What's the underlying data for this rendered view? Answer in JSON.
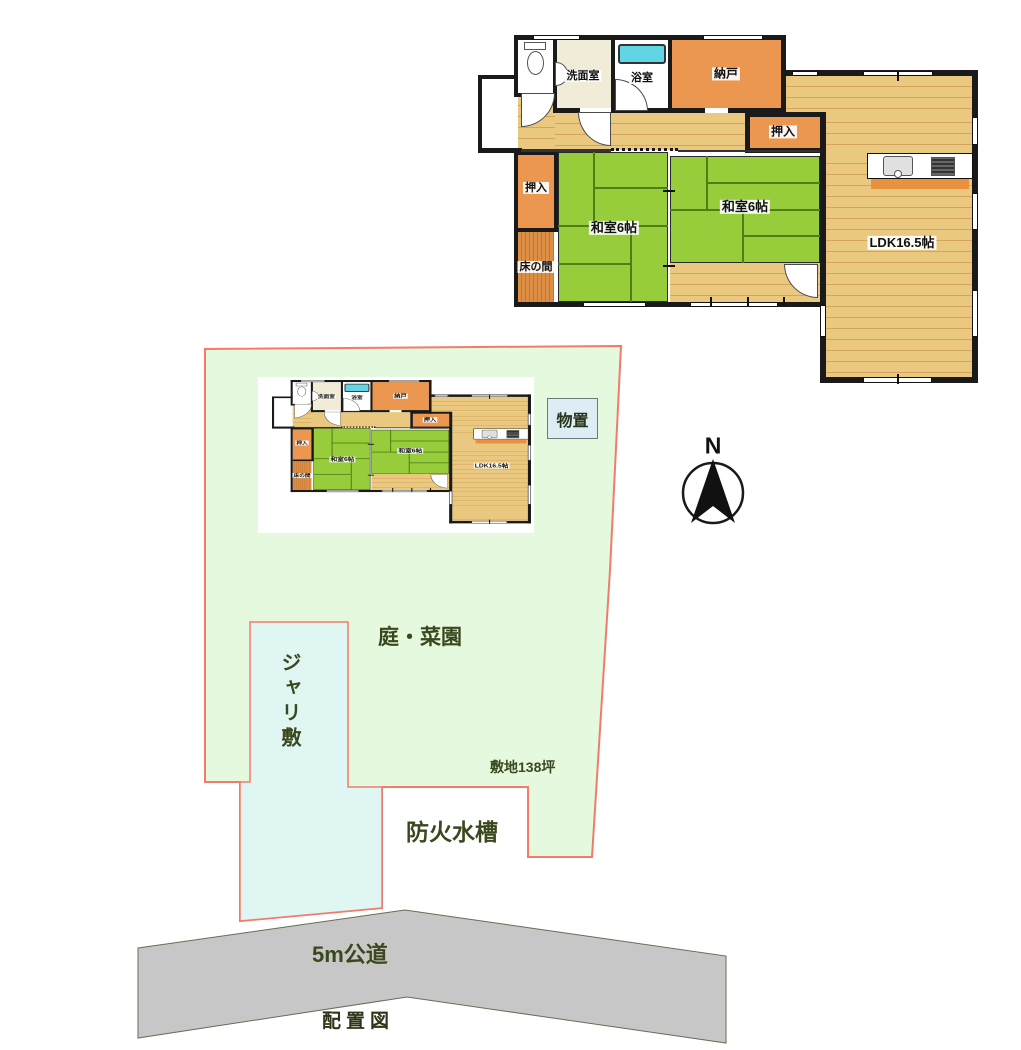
{
  "title": "配置図",
  "colors": {
    "wall": "#1a1a1a",
    "wood": "#eac87f",
    "woodline": "#d3a55c",
    "tatami": "#97cd3a",
    "seam": "#4f7d18",
    "orange": "#ec9750",
    "tokonoma": "#dd8f46",
    "cream": "#f1ecd7",
    "bathtile": "#dcdcd4",
    "tub": "#62d5e5",
    "porch": "#d8d8d8",
    "strip": "#e8913f",
    "sitegreen": "#e5f9df",
    "gravel": "#e0f6f2",
    "road": "#c7c7c7",
    "boundary": "#f27b6c",
    "olive": "#3a481e",
    "shedbg": "#dcedf4"
  },
  "floorplan": {
    "washroom": "洗面室",
    "bath": "浴室",
    "storage": "納戸",
    "closet_top": "押入",
    "closet_left": "押入",
    "tatami_left": "和室6帖",
    "tatami_right": "和室6帖",
    "alcove": "床の間",
    "ldk": "LDK16.5帖"
  },
  "site": {
    "shed": "物置",
    "garden": "庭・菜園",
    "gravel": "ジャリ敷",
    "area": "敷地138坪",
    "fire_tank": "防火水槽",
    "road": "5m公道",
    "compass": "N",
    "caption": "配置図"
  }
}
